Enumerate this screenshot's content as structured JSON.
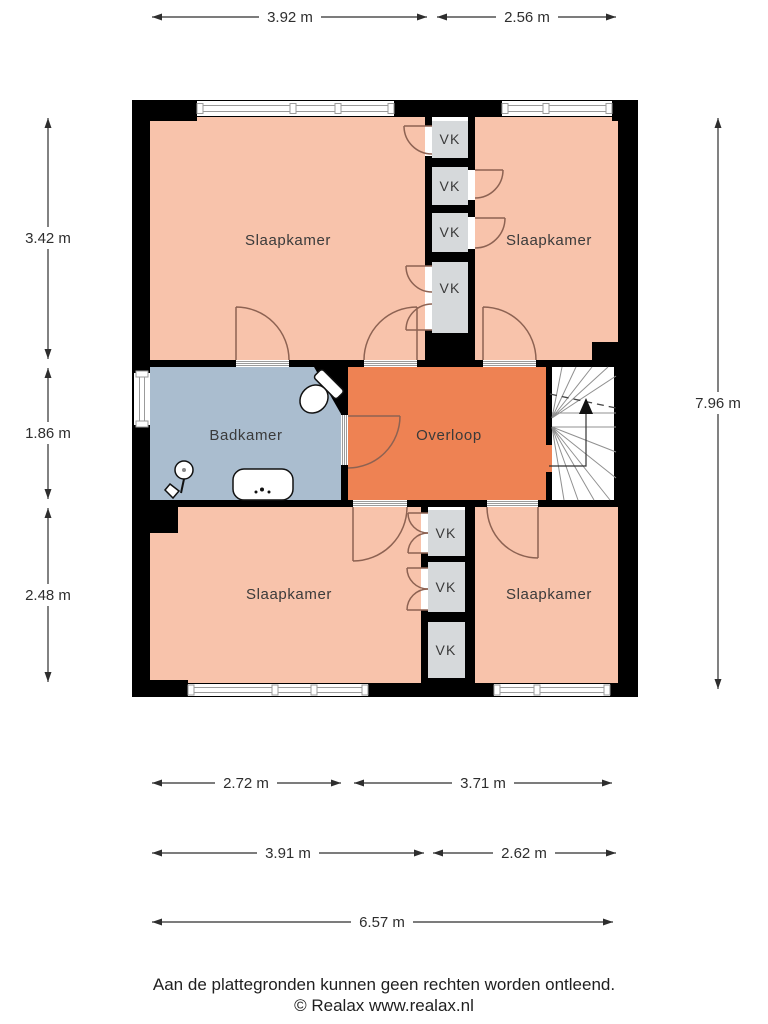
{
  "plan_type": "floor-plan",
  "rooms": {
    "bedroom_top_left": {
      "label": "Slaapkamer"
    },
    "bedroom_top_right": {
      "label": "Slaapkamer"
    },
    "bathroom": {
      "label": "Badkamer"
    },
    "landing": {
      "label": "Overloop"
    },
    "bedroom_bottom_left": {
      "label": "Slaapkamer"
    },
    "bedroom_bottom_right": {
      "label": "Slaapkamer"
    }
  },
  "closets": [
    {
      "label": "VK"
    },
    {
      "label": "VK"
    },
    {
      "label": "VK"
    },
    {
      "label": "VK"
    },
    {
      "label": "VK"
    },
    {
      "label": "VK"
    },
    {
      "label": "VK"
    }
  ],
  "dimensions": {
    "top": [
      {
        "label": "3.92 m"
      },
      {
        "label": "2.56 m"
      }
    ],
    "left": [
      {
        "label": "3.42 m"
      },
      {
        "label": "1.86 m"
      },
      {
        "label": "2.48 m"
      }
    ],
    "right": [
      {
        "label": "7.96 m"
      }
    ],
    "bottom_row1": [
      {
        "label": "2.72 m"
      },
      {
        "label": "3.71 m"
      }
    ],
    "bottom_row2": [
      {
        "label": "3.91 m"
      },
      {
        "label": "2.62 m"
      }
    ],
    "bottom_row3": [
      {
        "label": "6.57 m"
      }
    ]
  },
  "footer": {
    "disclaimer": "Aan de plattegronden kunnen geen rechten worden ontleend.",
    "copyright": "© Realax www.realax.nl"
  },
  "colors": {
    "bedroom_fill": "#f8c3ab",
    "landing_fill": "#ee8253",
    "bathroom_fill": "#aabdcf",
    "closet_fill": "#d6d9db",
    "wall": "#000000",
    "door_arc": "#8d6252",
    "window_frame": "#9b9b9b",
    "stair_line": "#909090",
    "text": "#2e2e2e"
  }
}
